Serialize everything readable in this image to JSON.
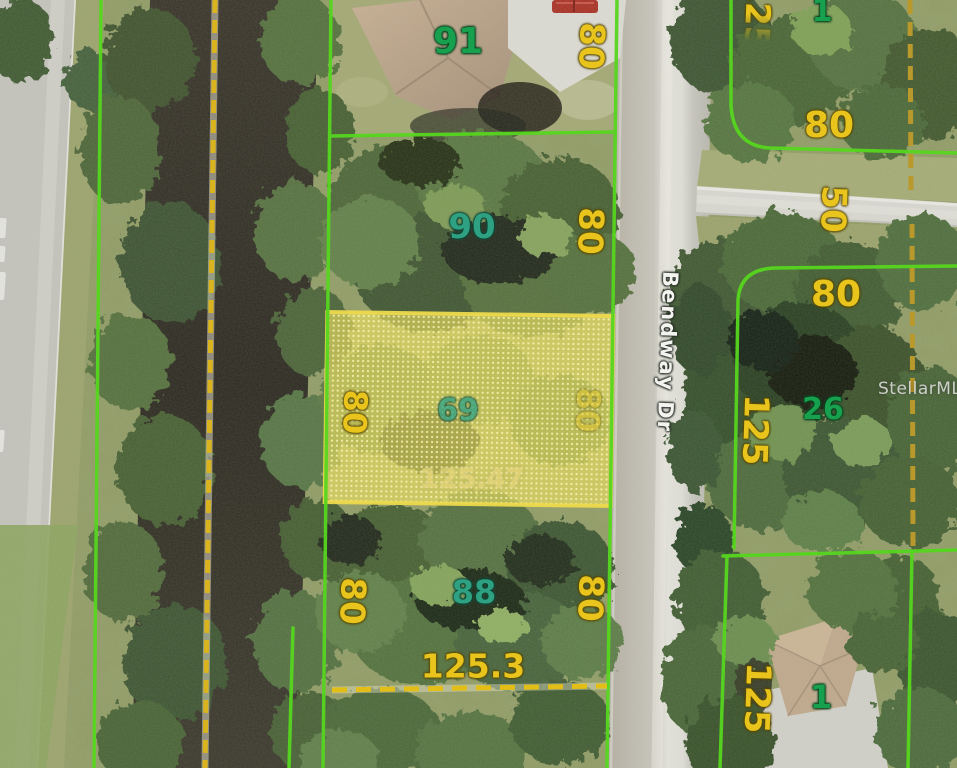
{
  "watermark": "StellarMLS",
  "street_label": "Bendway Dr",
  "lots": {
    "lot91": "91",
    "lot90": "90",
    "lot69": "69",
    "lot88": "88",
    "lot26": "26",
    "lot1_top": "1",
    "lot1_bottom": "1"
  },
  "dims": {
    "w91": "80",
    "w90": "80",
    "w69_left": "80",
    "w69_right": "80",
    "d69": "125.47",
    "w88_left": "80",
    "w88_right": "80",
    "d88": "125.3",
    "w_top_right": "80",
    "d_top_right": "125",
    "side50": "50",
    "w_mid_right": "80",
    "d_mid_right": "125",
    "d_bottom_right": "125"
  },
  "colors": {
    "parcel_line": "#56d61f",
    "dimension_text": "#e9c41d",
    "lot_id_green": "#17a14f",
    "lot_id_teal": "#2ea183",
    "highlight_fill": "#e8db5e",
    "canal_dash": "#d9b41e"
  }
}
